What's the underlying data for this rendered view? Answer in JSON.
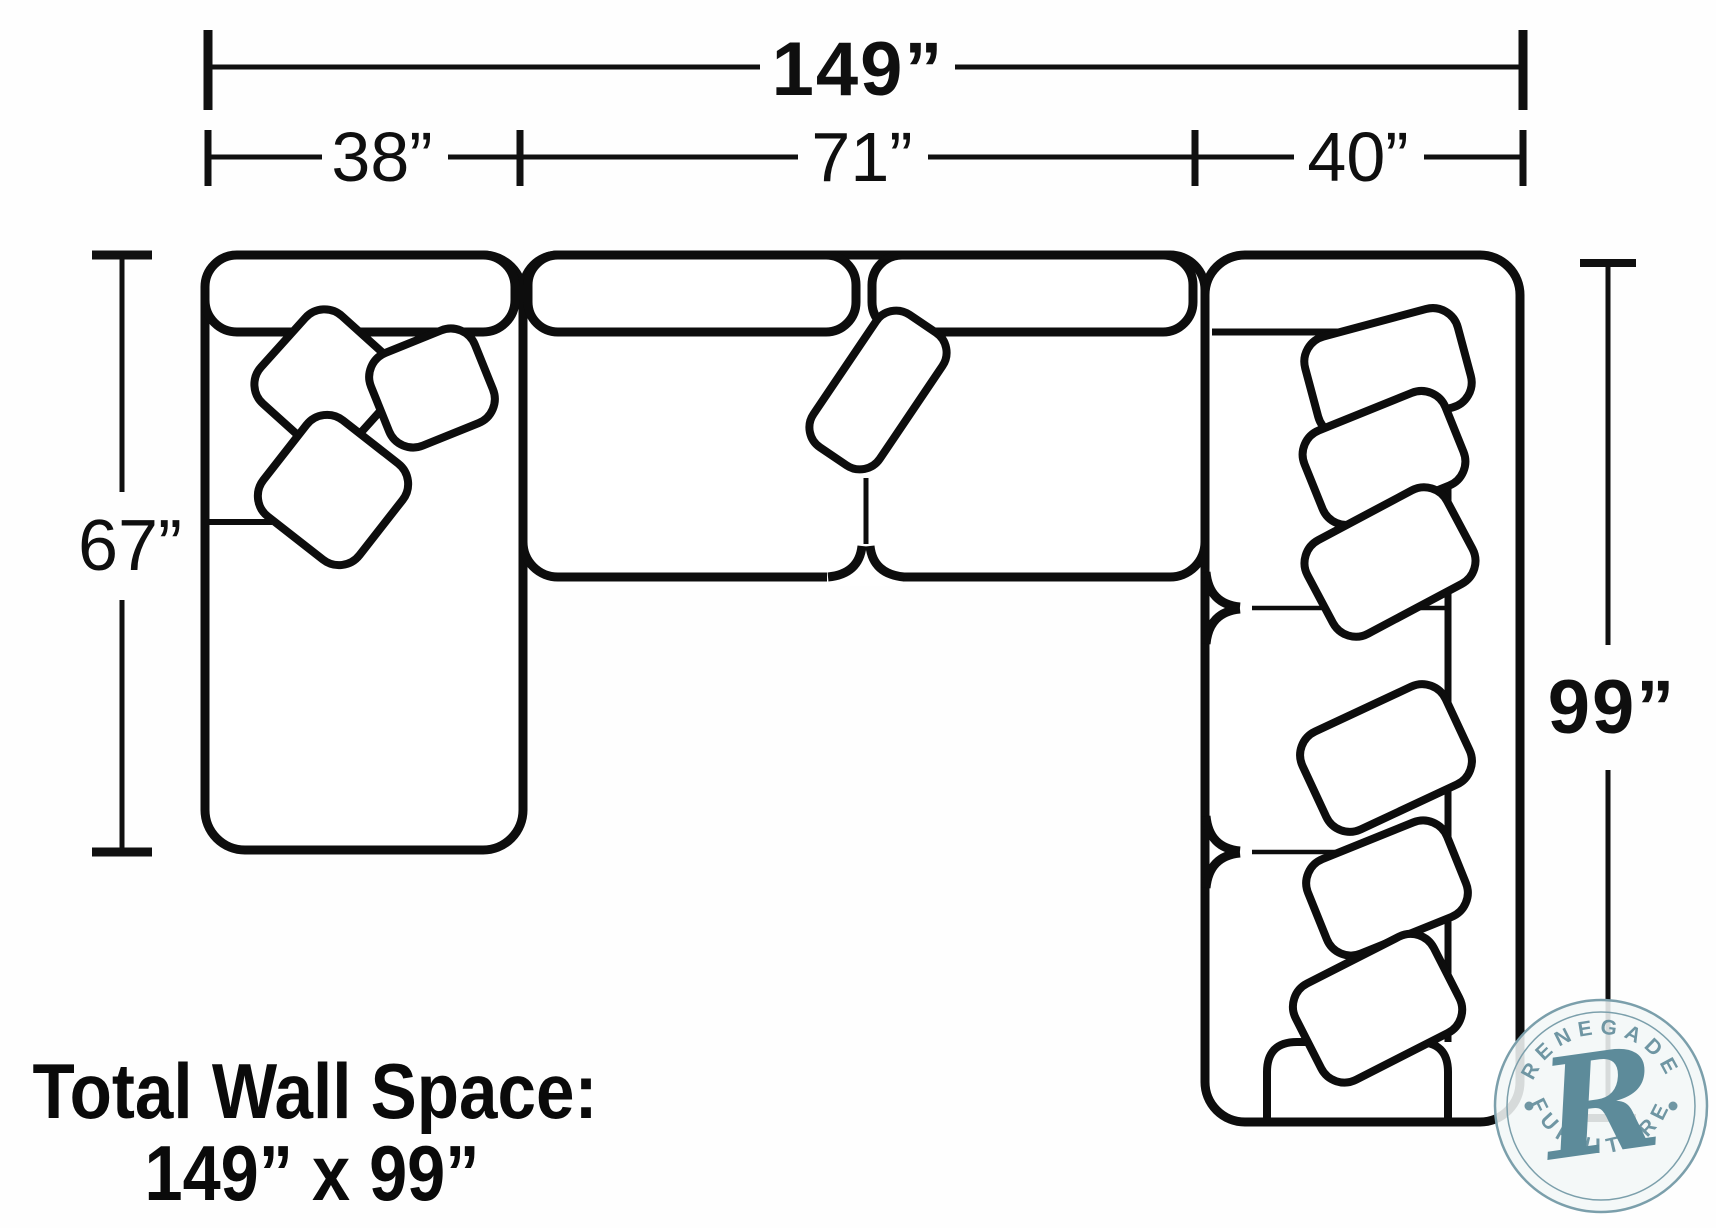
{
  "dimensions": {
    "overall_width": "149”",
    "segment_widths": [
      "38”",
      "71”",
      "40”"
    ],
    "left_depth": "67”",
    "right_depth": "99”"
  },
  "footer": {
    "line1": "Total Wall Space:",
    "line2": "149” x 99”"
  },
  "watermark": {
    "arc_top": "RENEGADE",
    "arc_bottom": "FURNITURE",
    "monogram": "R",
    "accent_color": "#6f96a3"
  },
  "colors": {
    "line": "#0d0d0d",
    "background": "#ffffff",
    "watermark_ring": "#7b9fab"
  }
}
